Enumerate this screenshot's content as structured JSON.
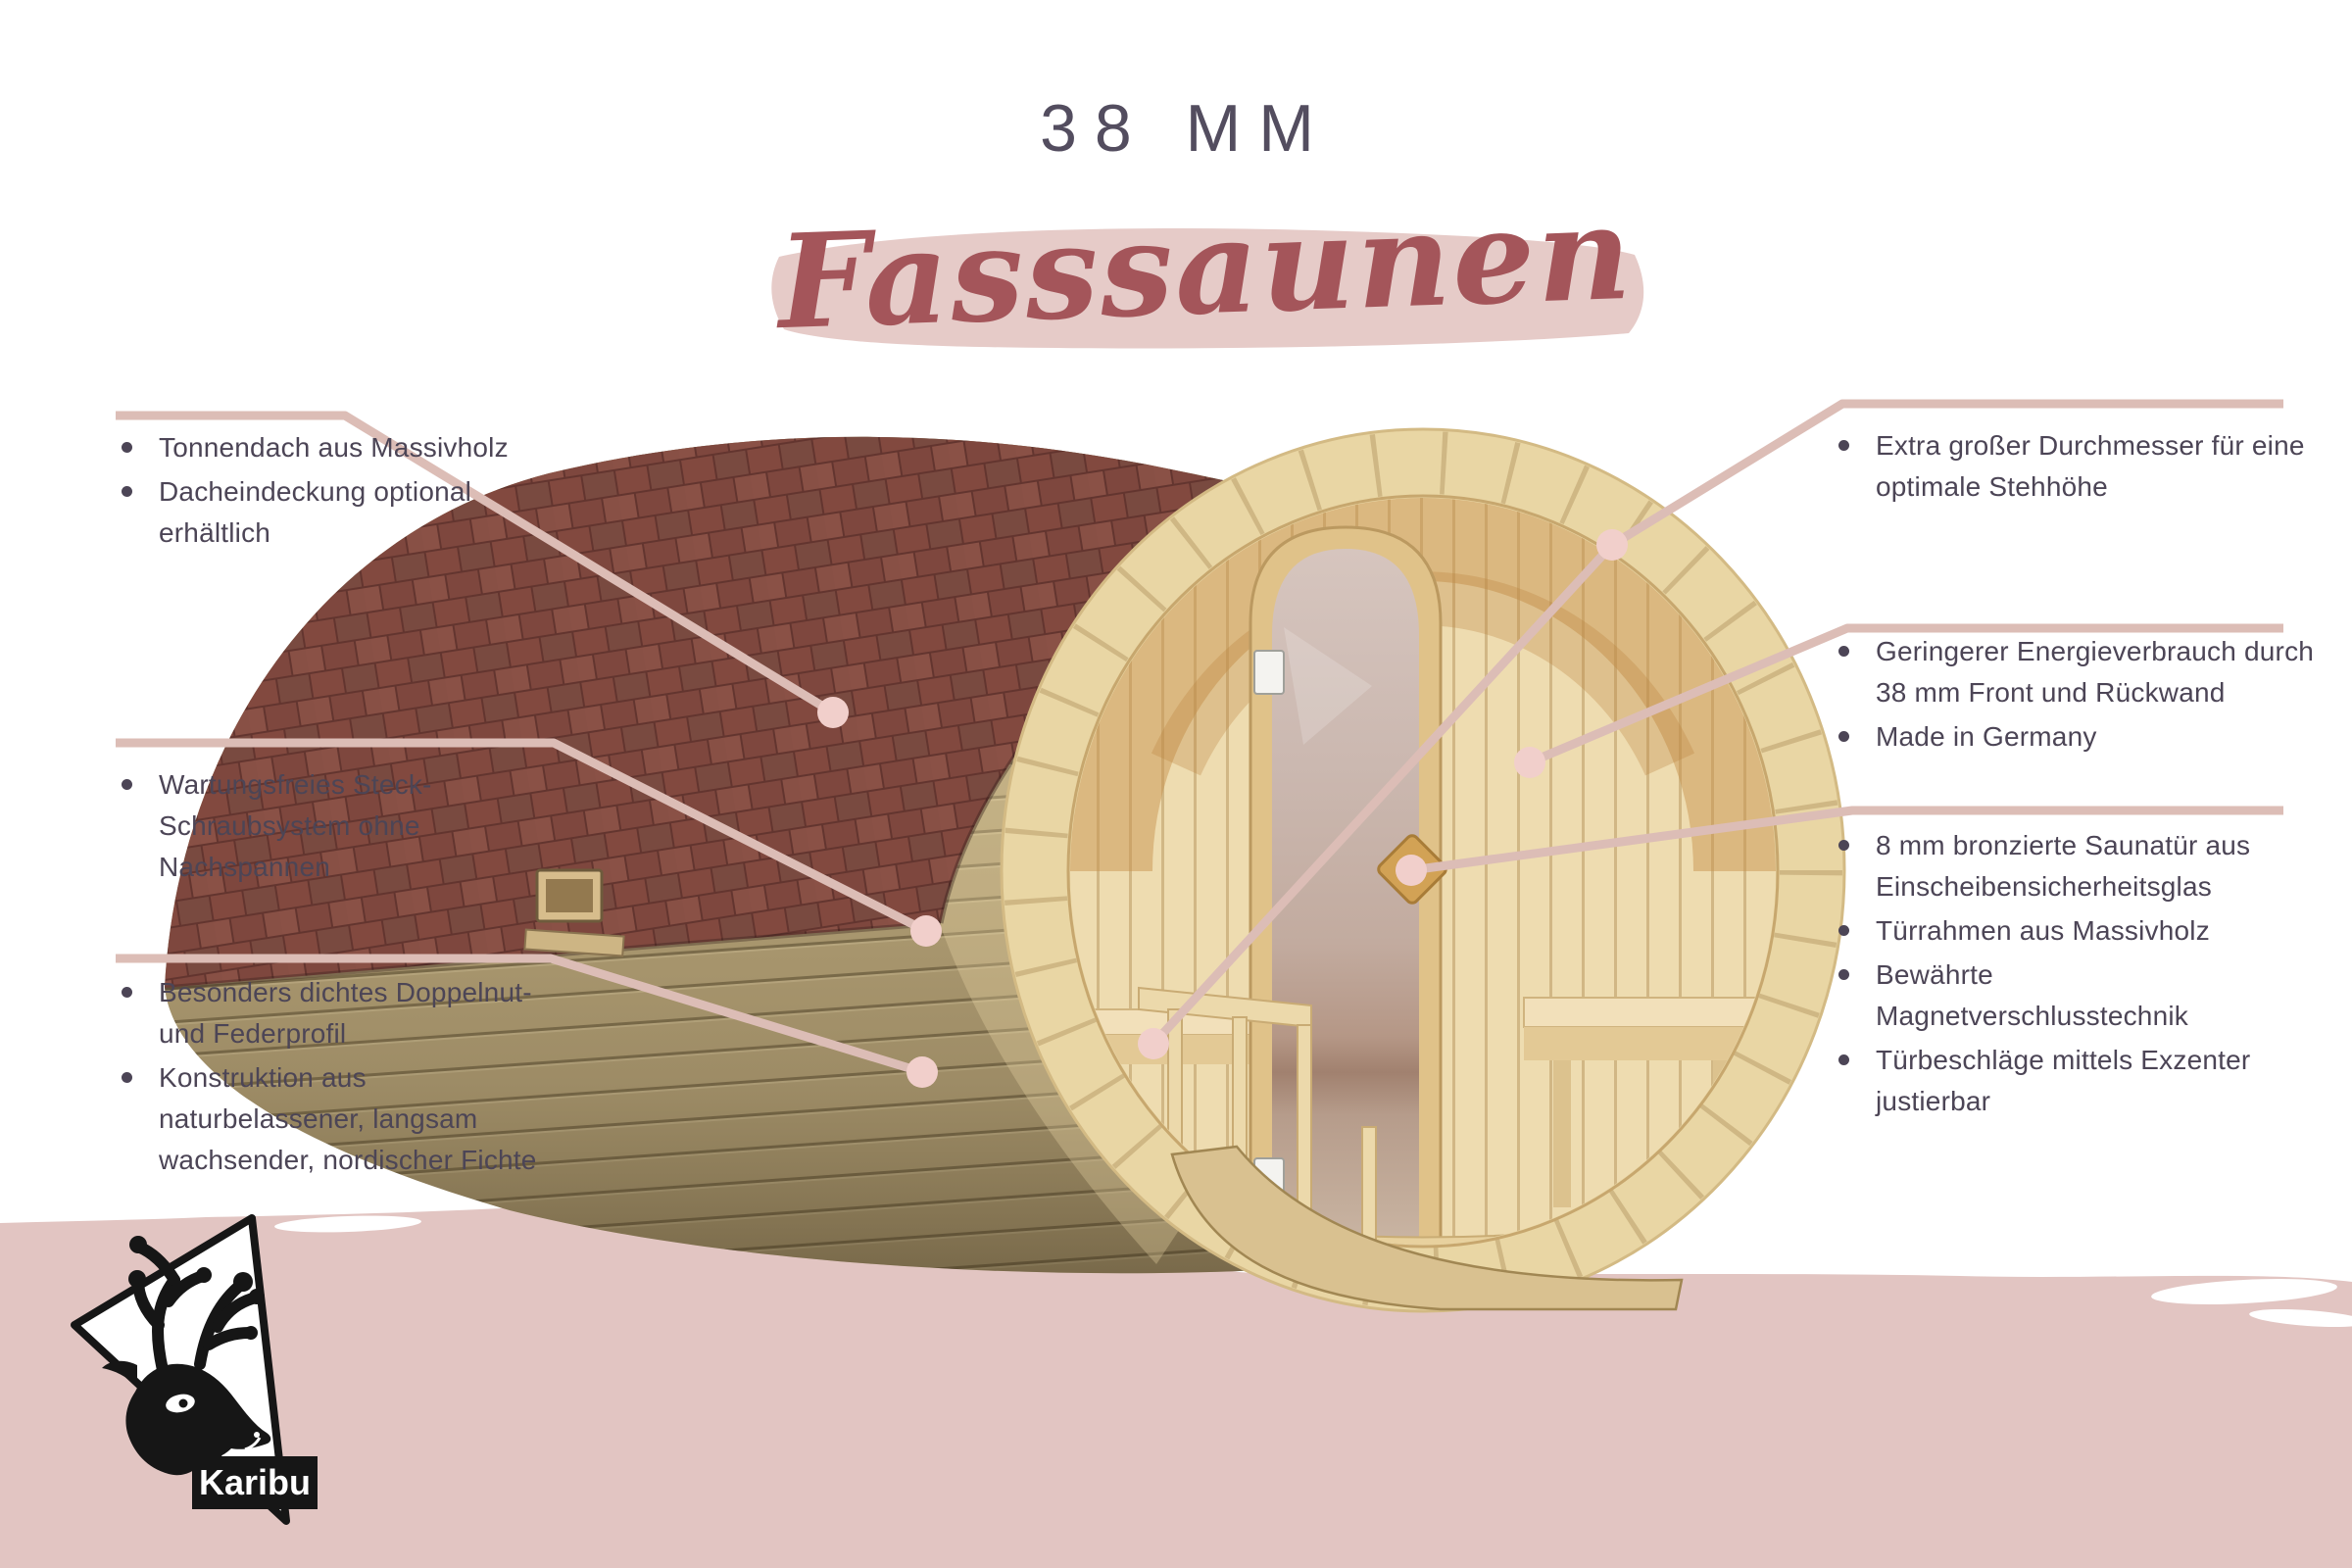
{
  "title": "38 MM",
  "subtitle": "Fasssaunen",
  "logo": {
    "brand": "Karibu",
    "icon": "deer-head-icon"
  },
  "callouts": {
    "left": [
      {
        "items": [
          "Tonnendach aus Massivholz",
          "Dacheindeckung optional erhältlich"
        ]
      },
      {
        "items": [
          "Wartungsfreies Steck-Schraubsystem ohne Nachspannen"
        ]
      },
      {
        "items": [
          "Besonders dichtes Doppelnut- und Federprofil",
          "Konstruktion aus naturbelassener, langsam wachsender, nordischer Fichte"
        ]
      }
    ],
    "right": [
      {
        "items": [
          "Extra großer Durchmesser für eine optimale Stehhöhe"
        ]
      },
      {
        "items": [
          "Geringerer Energieverbrauch durch 38 mm Front und Rückwand",
          "Made in Germany"
        ]
      },
      {
        "items": [
          "8 mm bronzierte Saunatür aus Einscheibensicherheitsglas",
          "Türrahmen aus Massivholz",
          "Bewährte Magnetverschlusstechnik",
          "Türbeschläge mittels Exzenter justierbar"
        ]
      }
    ]
  },
  "colors": {
    "band_pink": "#e2c5c2",
    "highlight_pink": "#e6cbc8",
    "callout_line": "#dcbdb6",
    "callout_dot": "#f1cfcb",
    "title_text": "#534d5f",
    "body_text": "#4c4556",
    "script_red": "#a4555a",
    "roof_shingle": "#7c463e",
    "wood_light": "#e9d6a4",
    "wood_khaki": "#b2a077",
    "logo_black": "#161616"
  }
}
